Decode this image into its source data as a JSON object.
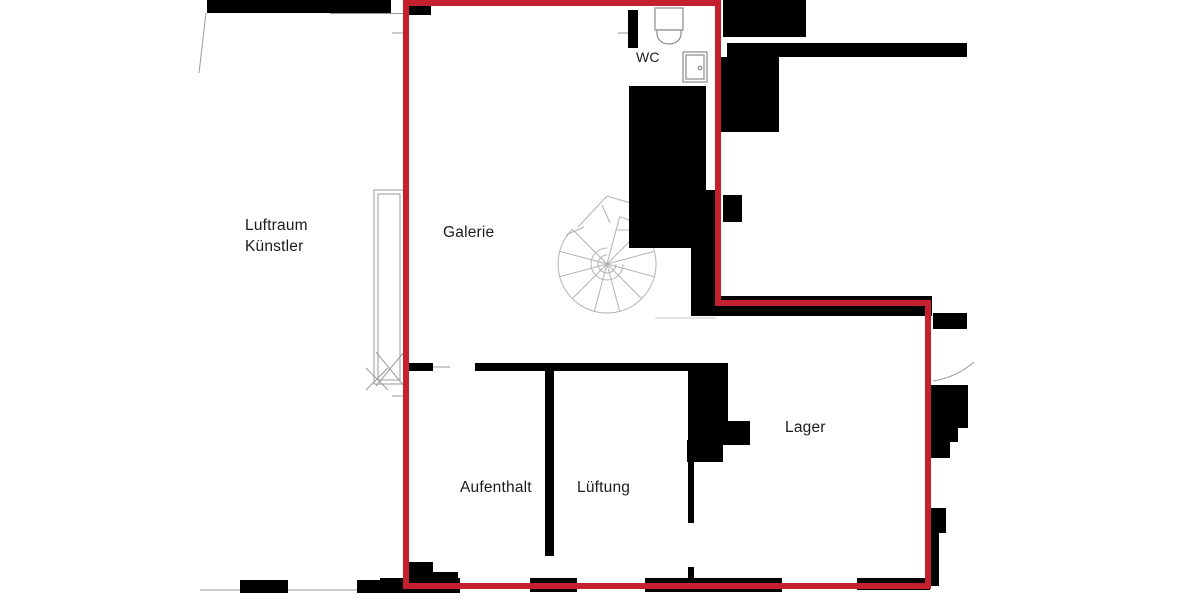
{
  "rooms": {
    "wc": "WC",
    "luftraum_line1": "Luftraum",
    "luftraum_line2": "Künstler",
    "galerie": "Galerie",
    "lager": "Lager",
    "aufenthalt": "Aufenthalt",
    "lueftung": "Lüftung"
  },
  "colors": {
    "boundary_red": "#c5202e",
    "wall_black": "#000000",
    "line_gray": "#9a9a9a",
    "stair_gray": "#b3b3b3",
    "fixture_gray": "#8a8a8a",
    "text": "#1b1b1b",
    "background": "#ffffff"
  }
}
